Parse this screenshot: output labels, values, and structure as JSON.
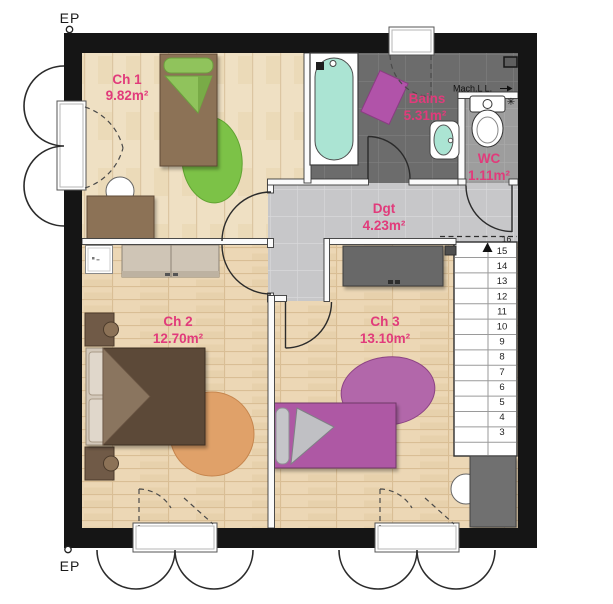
{
  "plan": {
    "ep_top": "EP",
    "ep_bottom": "EP",
    "rooms": {
      "ch1": {
        "name": "Ch 1",
        "area": "9.82m²"
      },
      "ch2": {
        "name": "Ch 2",
        "area": "12.70m²"
      },
      "ch3": {
        "name": "Ch 3",
        "area": "13.10m²"
      },
      "bains": {
        "name": "Bains",
        "area": "5.31m²"
      },
      "wc": {
        "name": "WC",
        "area": "1.11m²"
      },
      "dgt": {
        "name": "Dgt",
        "area": "4.23m²"
      }
    },
    "labels": {
      "washing_machine": "Mach.L L."
    },
    "stairs": {
      "top_number": "16",
      "numbers": [
        "15",
        "14",
        "13",
        "12",
        "11",
        "10",
        "9",
        "8",
        "7",
        "6",
        "5",
        "4",
        "3"
      ]
    },
    "colors": {
      "label_pink": "#e13b7b",
      "wall_black": "#151515",
      "wood_floor": "#ecd7b5",
      "bath_tile": "#6c6c6c",
      "wc_tile": "#9d9d9d",
      "hall_tile": "#c7c7c9",
      "water_cyan": "#abe4d3",
      "accent_purple": "#b153a9",
      "accent_green": "#7cc247",
      "rug_orange": "#e0a169",
      "duvet_brown": "#5c4837"
    }
  }
}
